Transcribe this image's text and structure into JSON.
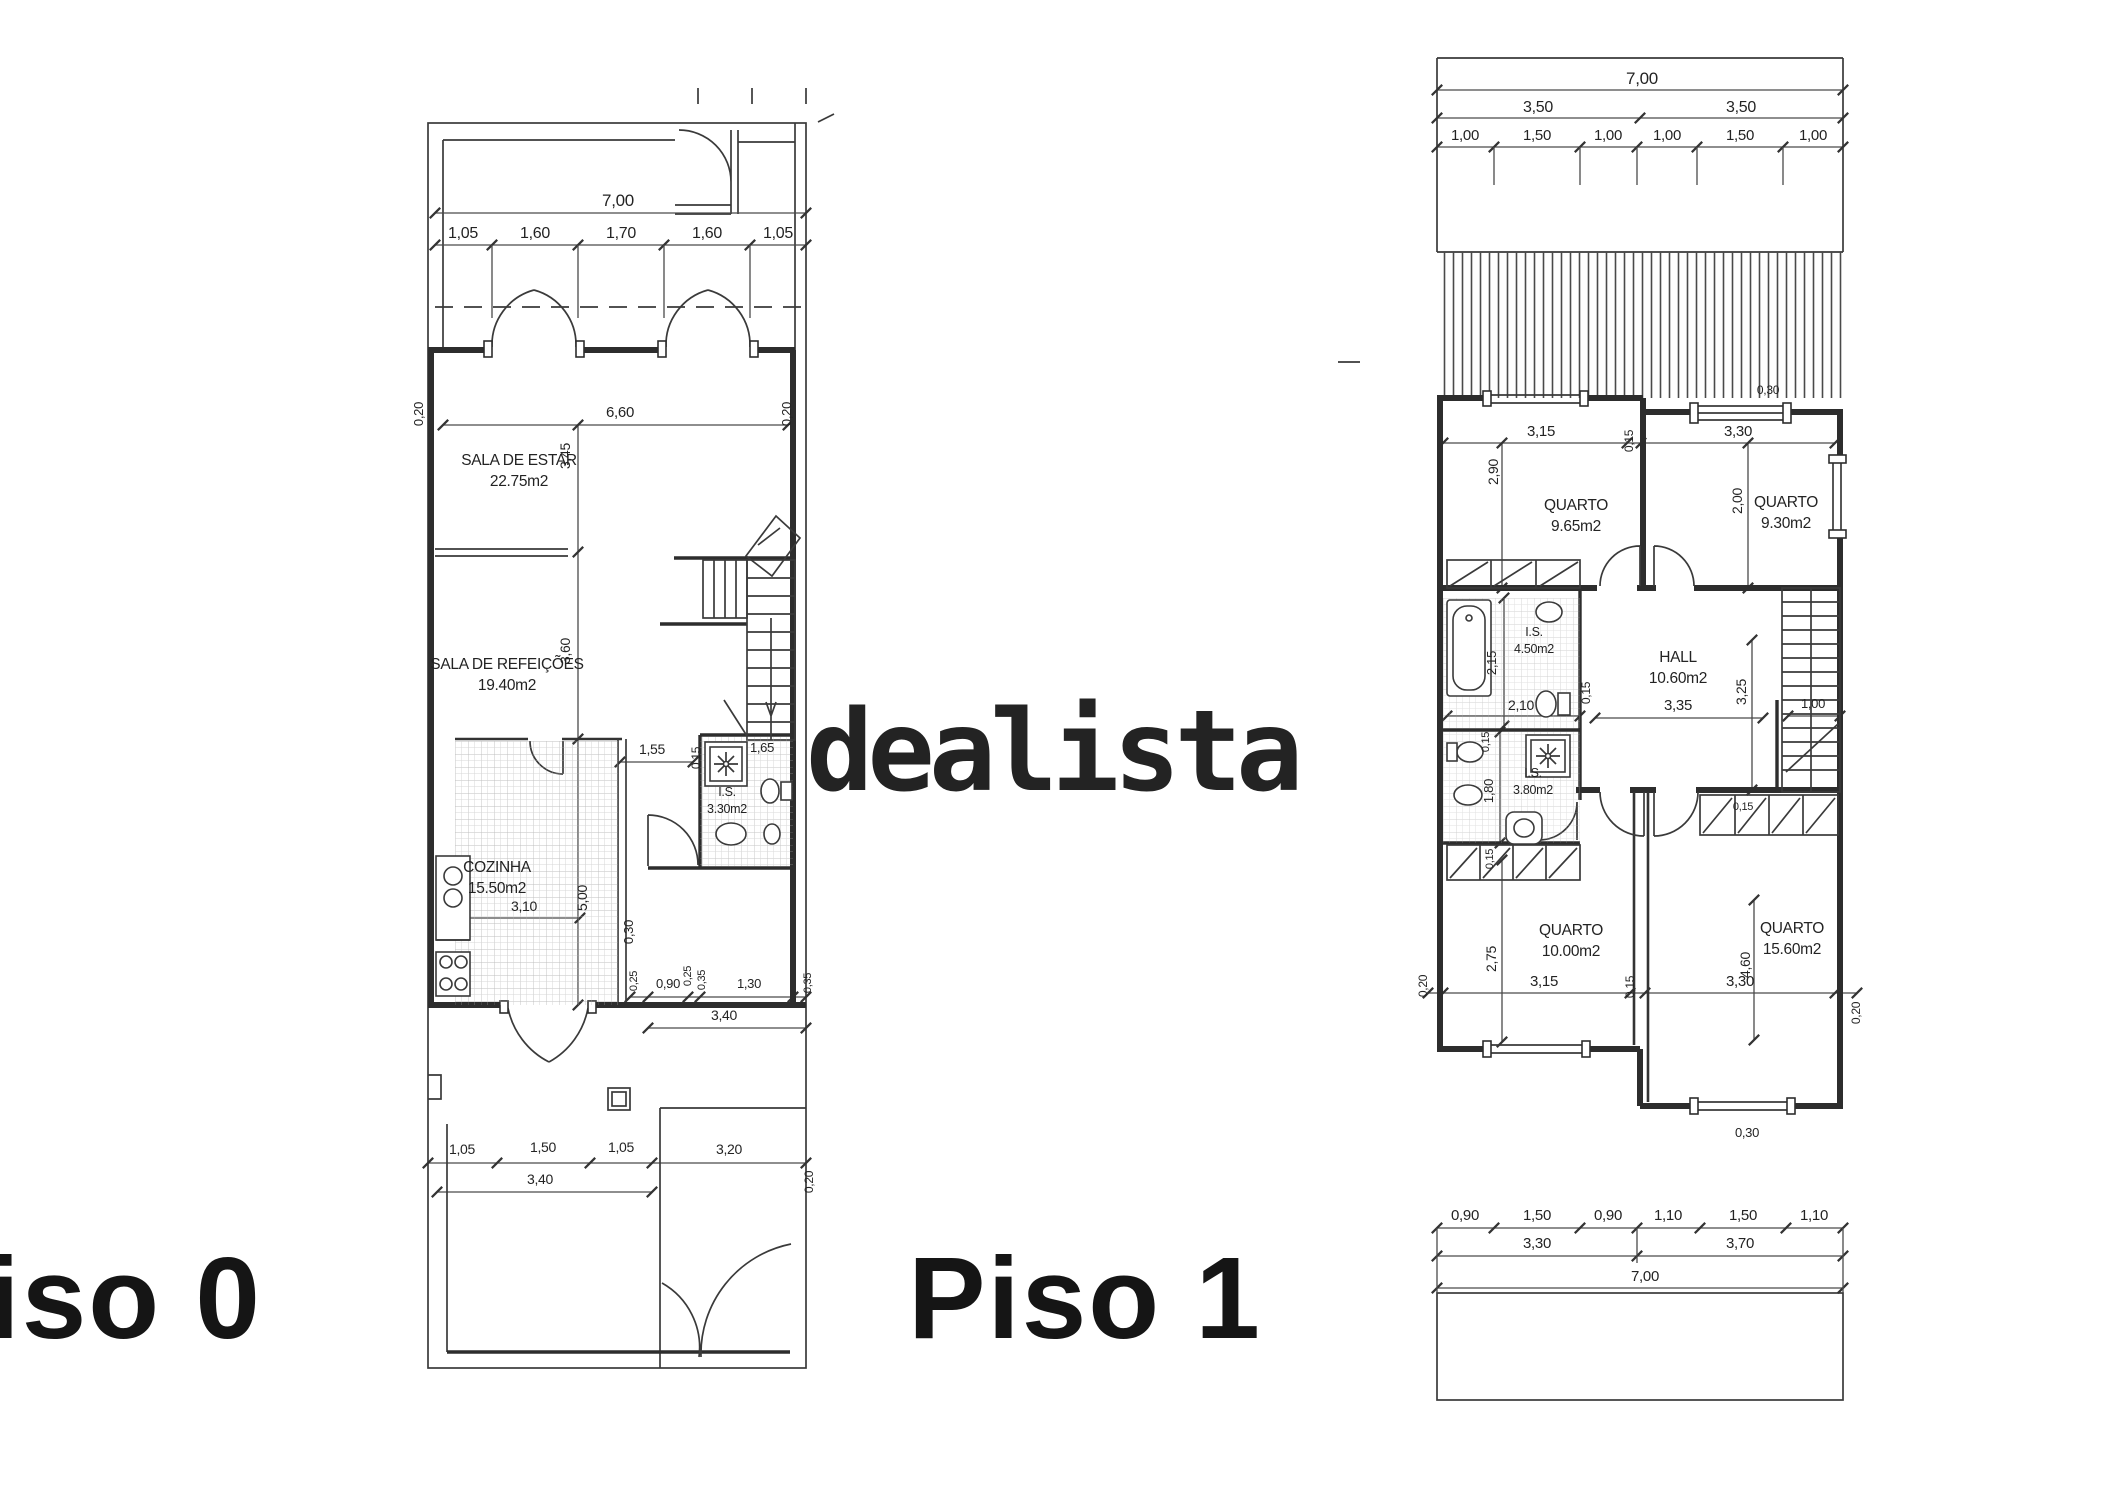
{
  "watermark": {
    "text": "dealista",
    "color": "#bdbdbd"
  },
  "line_color": "#3a3a3a",
  "floors": [
    {
      "title": "Piso 0",
      "rooms": [
        {
          "name": "SALA DE ESTAR",
          "area": "22.75m2",
          "x": 519,
          "y": 465
        },
        {
          "name": "SALA DE REFEIÇÕES",
          "area": "19.40m2",
          "x": 507,
          "y": 669
        },
        {
          "name": "COZINHA",
          "area": "15.50m2",
          "x": 497,
          "y": 872
        },
        {
          "name": "I.S.",
          "area": "3.30m2",
          "x": 727,
          "y": 796,
          "s": 12.5,
          "dy": 17
        }
      ],
      "dims": [
        {
          "t": "7,00",
          "x": 618,
          "y": 206,
          "s": 17
        },
        {
          "t": "1,05",
          "x": 463,
          "y": 238,
          "s": 16
        },
        {
          "t": "1,60",
          "x": 535,
          "y": 238,
          "s": 16
        },
        {
          "t": "1,70",
          "x": 621,
          "y": 238,
          "s": 16
        },
        {
          "t": "1,60",
          "x": 707,
          "y": 238,
          "s": 16
        },
        {
          "t": "1,05",
          "x": 778,
          "y": 238,
          "s": 16
        },
        {
          "t": "0,20",
          "x": 423,
          "y": 414,
          "r": -90,
          "s": 13
        },
        {
          "t": "6,60",
          "x": 620,
          "y": 417,
          "s": 15
        },
        {
          "t": "0,20",
          "x": 791,
          "y": 414,
          "r": -90,
          "s": 13
        },
        {
          "t": "3,45",
          "x": 570,
          "y": 456,
          "r": -90,
          "s": 14
        },
        {
          "t": "3,60",
          "x": 570,
          "y": 651,
          "r": -90,
          "s": 14
        },
        {
          "t": "1,55",
          "x": 652,
          "y": 754,
          "s": 14
        },
        {
          "t": "0,15",
          "x": 700,
          "y": 758,
          "r": -90,
          "s": 12
        },
        {
          "t": "1,65",
          "x": 762,
          "y": 752,
          "s": 13
        },
        {
          "t": "3,10",
          "x": 524,
          "y": 911,
          "s": 14
        },
        {
          "t": "5,00",
          "x": 587,
          "y": 898,
          "r": -90,
          "s": 14
        },
        {
          "t": "0,30",
          "x": 633,
          "y": 932,
          "r": -90,
          "s": 13
        },
        {
          "t": "0,25",
          "x": 637,
          "y": 981,
          "r": -90,
          "s": 11
        },
        {
          "t": "0,90",
          "x": 668,
          "y": 988,
          "s": 13
        },
        {
          "t": "0,25",
          "x": 691,
          "y": 976,
          "r": -90,
          "s": 11
        },
        {
          "t": "0,35",
          "x": 705,
          "y": 980,
          "r": -90,
          "s": 11
        },
        {
          "t": "1,30",
          "x": 749,
          "y": 988,
          "s": 13
        },
        {
          "t": "0,35",
          "x": 811,
          "y": 983,
          "r": -90,
          "s": 11
        },
        {
          "t": "3,40",
          "x": 724,
          "y": 1020,
          "s": 14
        },
        {
          "t": "1,05",
          "x": 462,
          "y": 1154,
          "s": 14
        },
        {
          "t": "1,50",
          "x": 543,
          "y": 1152,
          "s": 14
        },
        {
          "t": "1,05",
          "x": 621,
          "y": 1152,
          "s": 14
        },
        {
          "t": "3,20",
          "x": 729,
          "y": 1154,
          "s": 14
        },
        {
          "t": "3,40",
          "x": 540,
          "y": 1184,
          "s": 14
        },
        {
          "t": "0,20",
          "x": 813,
          "y": 1182,
          "r": -90,
          "s": 12
        }
      ]
    },
    {
      "title": "Piso 1",
      "rooms": [
        {
          "name": "QUARTO",
          "area": "9.65m2",
          "x": 1576,
          "y": 510
        },
        {
          "name": "QUARTO",
          "area": "9.30m2",
          "x": 1786,
          "y": 507
        },
        {
          "name": "HALL",
          "area": "10.60m2",
          "x": 1678,
          "y": 662
        },
        {
          "name": "I.S.",
          "area": "4.50m2",
          "x": 1534,
          "y": 636,
          "s": 12.5,
          "dy": 17
        },
        {
          "name": "I.S.",
          "area": "3.80m2",
          "x": 1533,
          "y": 777,
          "s": 12.5,
          "dy": 17
        },
        {
          "name": "QUARTO",
          "area": "10.00m2",
          "x": 1571,
          "y": 935
        },
        {
          "name": "QUARTO",
          "area": "15.60m2",
          "x": 1792,
          "y": 933
        }
      ],
      "dims": [
        {
          "t": "7,00",
          "x": 1642,
          "y": 84,
          "s": 17
        },
        {
          "t": "3,50",
          "x": 1538,
          "y": 112,
          "s": 16
        },
        {
          "t": "3,50",
          "x": 1741,
          "y": 112,
          "s": 16
        },
        {
          "t": "1,00",
          "x": 1465,
          "y": 140,
          "s": 15
        },
        {
          "t": "1,50",
          "x": 1537,
          "y": 140,
          "s": 15
        },
        {
          "t": "1,00",
          "x": 1608,
          "y": 140,
          "s": 15
        },
        {
          "t": "1,00",
          "x": 1667,
          "y": 140,
          "s": 15
        },
        {
          "t": "1,50",
          "x": 1740,
          "y": 140,
          "s": 15
        },
        {
          "t": "1,00",
          "x": 1813,
          "y": 140,
          "s": 15
        },
        {
          "t": "0,30",
          "x": 1768,
          "y": 394,
          "s": 12
        },
        {
          "t": "3,15",
          "x": 1541,
          "y": 436,
          "s": 15
        },
        {
          "t": "0,15",
          "x": 1633,
          "y": 441,
          "r": -90,
          "s": 12
        },
        {
          "t": "3,30",
          "x": 1738,
          "y": 436,
          "s": 15
        },
        {
          "t": "2,90",
          "x": 1498,
          "y": 472,
          "r": -90,
          "s": 14
        },
        {
          "t": "2,00",
          "x": 1742,
          "y": 501,
          "r": -90,
          "s": 14
        },
        {
          "t": "0,15",
          "x": 1590,
          "y": 693,
          "r": -90,
          "s": 12
        },
        {
          "t": "2,15",
          "x": 1496,
          "y": 663,
          "r": -90,
          "s": 13
        },
        {
          "t": "2,10",
          "x": 1521,
          "y": 710,
          "s": 14
        },
        {
          "t": "3,35",
          "x": 1678,
          "y": 710,
          "s": 15
        },
        {
          "t": "3,25",
          "x": 1746,
          "y": 692,
          "r": -90,
          "s": 14
        },
        {
          "t": "1,00",
          "x": 1813,
          "y": 708,
          "s": 13
        },
        {
          "t": "0,15",
          "x": 1489,
          "y": 742,
          "r": -90,
          "s": 11
        },
        {
          "t": "1,80",
          "x": 1493,
          "y": 791,
          "r": -90,
          "s": 13
        },
        {
          "t": "0,15",
          "x": 1493,
          "y": 859,
          "r": -90,
          "s": 11
        },
        {
          "t": "0,15",
          "x": 1743,
          "y": 810,
          "s": 11
        },
        {
          "t": "2,75",
          "x": 1496,
          "y": 959,
          "r": -90,
          "s": 14
        },
        {
          "t": "3,15",
          "x": 1544,
          "y": 986,
          "s": 15
        },
        {
          "t": "0,15",
          "x": 1634,
          "y": 987,
          "r": -90,
          "s": 12
        },
        {
          "t": "3,30",
          "x": 1740,
          "y": 986,
          "s": 15
        },
        {
          "t": "4,60",
          "x": 1750,
          "y": 965,
          "r": -90,
          "s": 14
        },
        {
          "t": "0,20",
          "x": 1427,
          "y": 986,
          "r": -90,
          "s": 12
        },
        {
          "t": "0,20",
          "x": 1860,
          "y": 1013,
          "r": -90,
          "s": 12
        },
        {
          "t": "0,30",
          "x": 1747,
          "y": 1137,
          "s": 13
        },
        {
          "t": "0,90",
          "x": 1465,
          "y": 1220,
          "s": 15
        },
        {
          "t": "1,50",
          "x": 1537,
          "y": 1220,
          "s": 15
        },
        {
          "t": "0,90",
          "x": 1608,
          "y": 1220,
          "s": 15
        },
        {
          "t": "1,10",
          "x": 1668,
          "y": 1220,
          "s": 15
        },
        {
          "t": "1,50",
          "x": 1743,
          "y": 1220,
          "s": 15
        },
        {
          "t": "1,10",
          "x": 1814,
          "y": 1220,
          "s": 15
        },
        {
          "t": "3,30",
          "x": 1537,
          "y": 1248,
          "s": 15
        },
        {
          "t": "3,70",
          "x": 1740,
          "y": 1248,
          "s": 15
        },
        {
          "t": "7,00",
          "x": 1645,
          "y": 1281,
          "s": 15
        }
      ]
    }
  ]
}
